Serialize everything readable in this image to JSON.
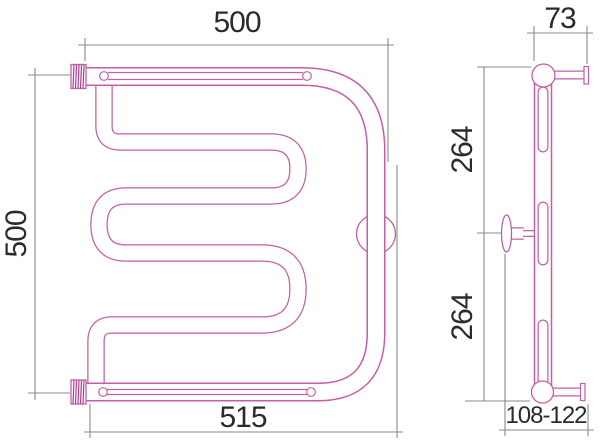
{
  "drawing": {
    "type": "technical-drawing",
    "subject": "towel-radiator two-view dimension drawing",
    "views": {
      "front": {
        "dimensions": {
          "width_top": "500",
          "height_left": "500",
          "width_bottom": "515"
        }
      },
      "side": {
        "dimensions": {
          "depth_top": "73",
          "span_upper": "264",
          "span_lower": "264",
          "wall_distance": "108-122"
        }
      }
    },
    "colors": {
      "outline": "#c45fa5",
      "hatch": "#b03a94",
      "dimension_line": "#8a8a8a",
      "text": "#2b2b2b",
      "background": "#ffffff"
    }
  }
}
